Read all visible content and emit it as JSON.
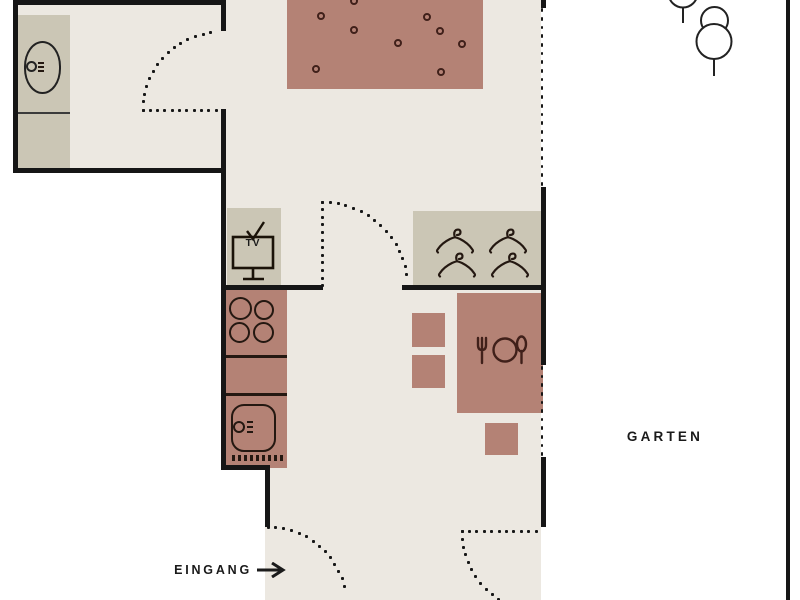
{
  "diagram_type": "apartment-floor-plan",
  "labels": {
    "garden": "GARTEN",
    "entrance": "EINGANG",
    "tv": "TV"
  },
  "colors": {
    "wall": "#161616",
    "floor": "#ECE8E1",
    "outside": "#FFFFFF",
    "furniture_beige": "#CBC6B5",
    "furniture_rose": "#B48275",
    "icon_dark": "#241811",
    "icon_maroon": "#40201A",
    "text": "#1A1A1A",
    "tree_outline": "#222222"
  },
  "rooms": [
    {
      "name": "bathroom",
      "items": [
        "washbasin",
        "counter",
        "door-swing"
      ]
    },
    {
      "name": "living-room",
      "items": [
        "rug-with-dots",
        "tv-stand",
        "door-swing"
      ]
    },
    {
      "name": "wardrobe-nook",
      "items": [
        "four-clothes-hangers"
      ]
    },
    {
      "name": "kitchen",
      "items": [
        "stove-four-burners",
        "counter",
        "sink-with-drainboard"
      ]
    },
    {
      "name": "dining-area",
      "items": [
        "table-with-place-setting",
        "three-chairs"
      ]
    },
    {
      "name": "entrance-corridor",
      "items": [
        "entrance-door-swing",
        "entrance-arrow"
      ]
    },
    {
      "name": "garden",
      "items": [
        "two-trees",
        "terrace-door-swing",
        "dotted-windows"
      ]
    }
  ]
}
